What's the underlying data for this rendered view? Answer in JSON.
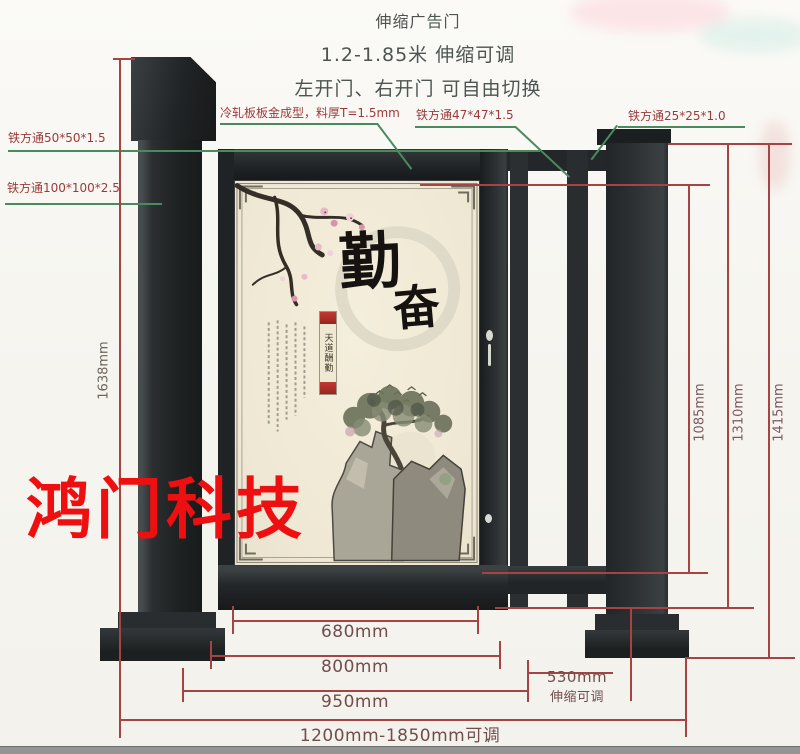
{
  "header": {
    "line1": "伸缩广告门",
    "line2": "1.2-1.85米 伸缩可调",
    "line3": "左开门、右开门 可自由切换"
  },
  "labels": {
    "cold_rolled_panel": "冷轧板板金成型，料厚T=1.5mm",
    "tube_50": "铁方通50*50*1.5",
    "tube_100": "铁方通100*100*2.5",
    "tube_47": "铁方通47*47*1.5",
    "tube_25": "铁方通25*25*1.0"
  },
  "dimensions": {
    "left_height": "1638mm",
    "right_height_inner": "1085mm",
    "right_height_mid": "1310mm",
    "right_height_outer": "1415mm",
    "width_panel": "680mm",
    "width_leaf": "800mm",
    "width_frame": "950mm",
    "width_range": "1200mm-1850mm可调",
    "tele_width": "530mm",
    "tele_note": "伸缩可调"
  },
  "panel": {
    "calligraphy_main": "勤",
    "calligraphy_sub": "奋",
    "couplet": "天道酬勤"
  },
  "watermark": "鸿门科技",
  "colors": {
    "steel": "#26292b",
    "panel_bg": "#f1ead8",
    "dimension_line": "#a64343",
    "dimension_text": "#714d4b",
    "label_text": "#9c3a3a",
    "leader_green": "#4a8a5e",
    "watermark_red": "#ee1010",
    "couplet_red": "#b5372e"
  }
}
